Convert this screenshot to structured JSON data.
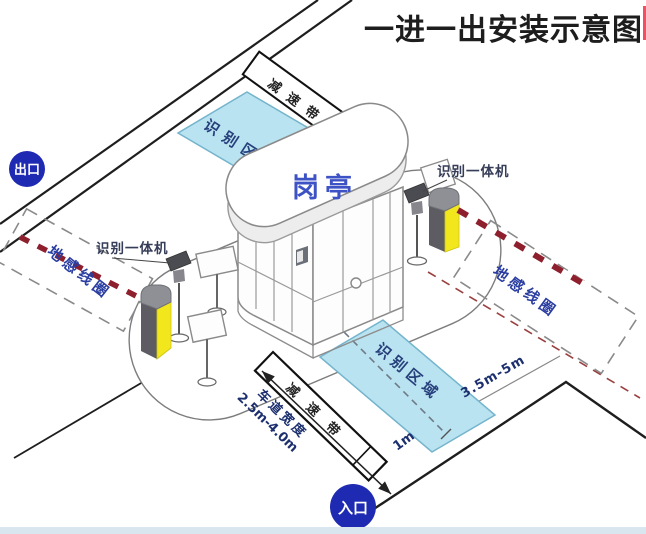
{
  "title": "一进一出安装示意图",
  "badges": {
    "exit": "出口",
    "entrance": "入口"
  },
  "booth": {
    "label": "岗亭"
  },
  "zones": {
    "recognition_top": "识别区域",
    "recognition_bottom": "识别区域",
    "speed_bump_top": "减速带",
    "speed_bump_bottom": "减速带",
    "ground_loop_left": "地感线圈",
    "ground_loop_right": "地感线圈"
  },
  "devices": {
    "reader_left": "识别一体机",
    "reader_right": "识别一体机"
  },
  "dimensions": {
    "loop_distance": "3.5m-5m",
    "stop_line": "1m",
    "lane_width_label": "车道宽度",
    "lane_width_value": "2.5m-4.0m"
  },
  "colors": {
    "badge_blue": "#1f2ab2",
    "zone_fill": "#b9e3f0",
    "zone_border": "#74b4cc",
    "barrier_yellow": "#f1e71c",
    "arm_stripe_red": "#8e1f2d",
    "booth_label_blue": "#3d52c4",
    "annotation_blue": "#2a3da0",
    "title_black": "#1d1d1d",
    "bottom_strip": "#d9e6ef"
  }
}
